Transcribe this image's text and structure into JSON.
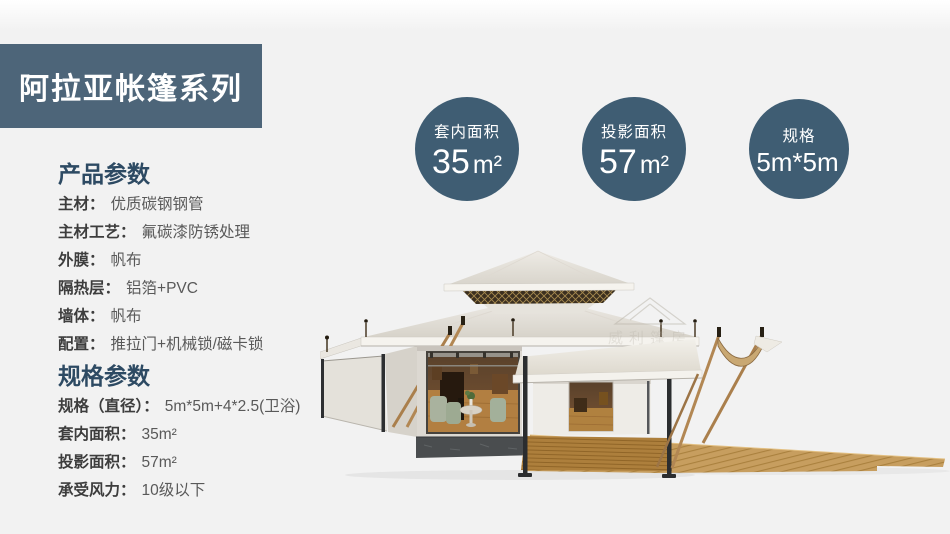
{
  "banner": {
    "title": "阿拉亚帐篷系列"
  },
  "colors": {
    "banner_bg": "#4d6579",
    "circle_bg": "#3f5d73",
    "heading_text": "#2d4a63",
    "page_bg": "#f2f2f2"
  },
  "stat_circles": [
    {
      "label": "套内面积",
      "value": "35",
      "unit": "m²"
    },
    {
      "label": "投影面积",
      "value": "57",
      "unit": "m²"
    },
    {
      "label": "规格",
      "value": "5m*5m",
      "unit": ""
    }
  ],
  "product_params": {
    "heading": "产品参数",
    "items": [
      {
        "label": "主材：",
        "value": "优质碳钢钢管"
      },
      {
        "label": "主材工艺：",
        "value": "氟碳漆防锈处理"
      },
      {
        "label": "外膜：",
        "value": "帆布"
      },
      {
        "label": "隔热层：",
        "value": "铝箔+PVC"
      },
      {
        "label": "墙体：",
        "value": "帆布"
      },
      {
        "label": "配置：",
        "value": "推拉门+机械锁/磁卡锁"
      }
    ]
  },
  "spec_params": {
    "heading": "规格参数",
    "items": [
      {
        "label": "规格（直径）：",
        "value": "5m*5m+4*2.5(卫浴)"
      },
      {
        "label": "套内面积：",
        "value": "35m²"
      },
      {
        "label": "投影面积：",
        "value": "57m²"
      },
      {
        "label": "承受风力：",
        "value": "10级以下"
      }
    ]
  },
  "tent": {
    "watermark_cn": "威利篷房",
    "watermark_en": "WELL TENT"
  }
}
